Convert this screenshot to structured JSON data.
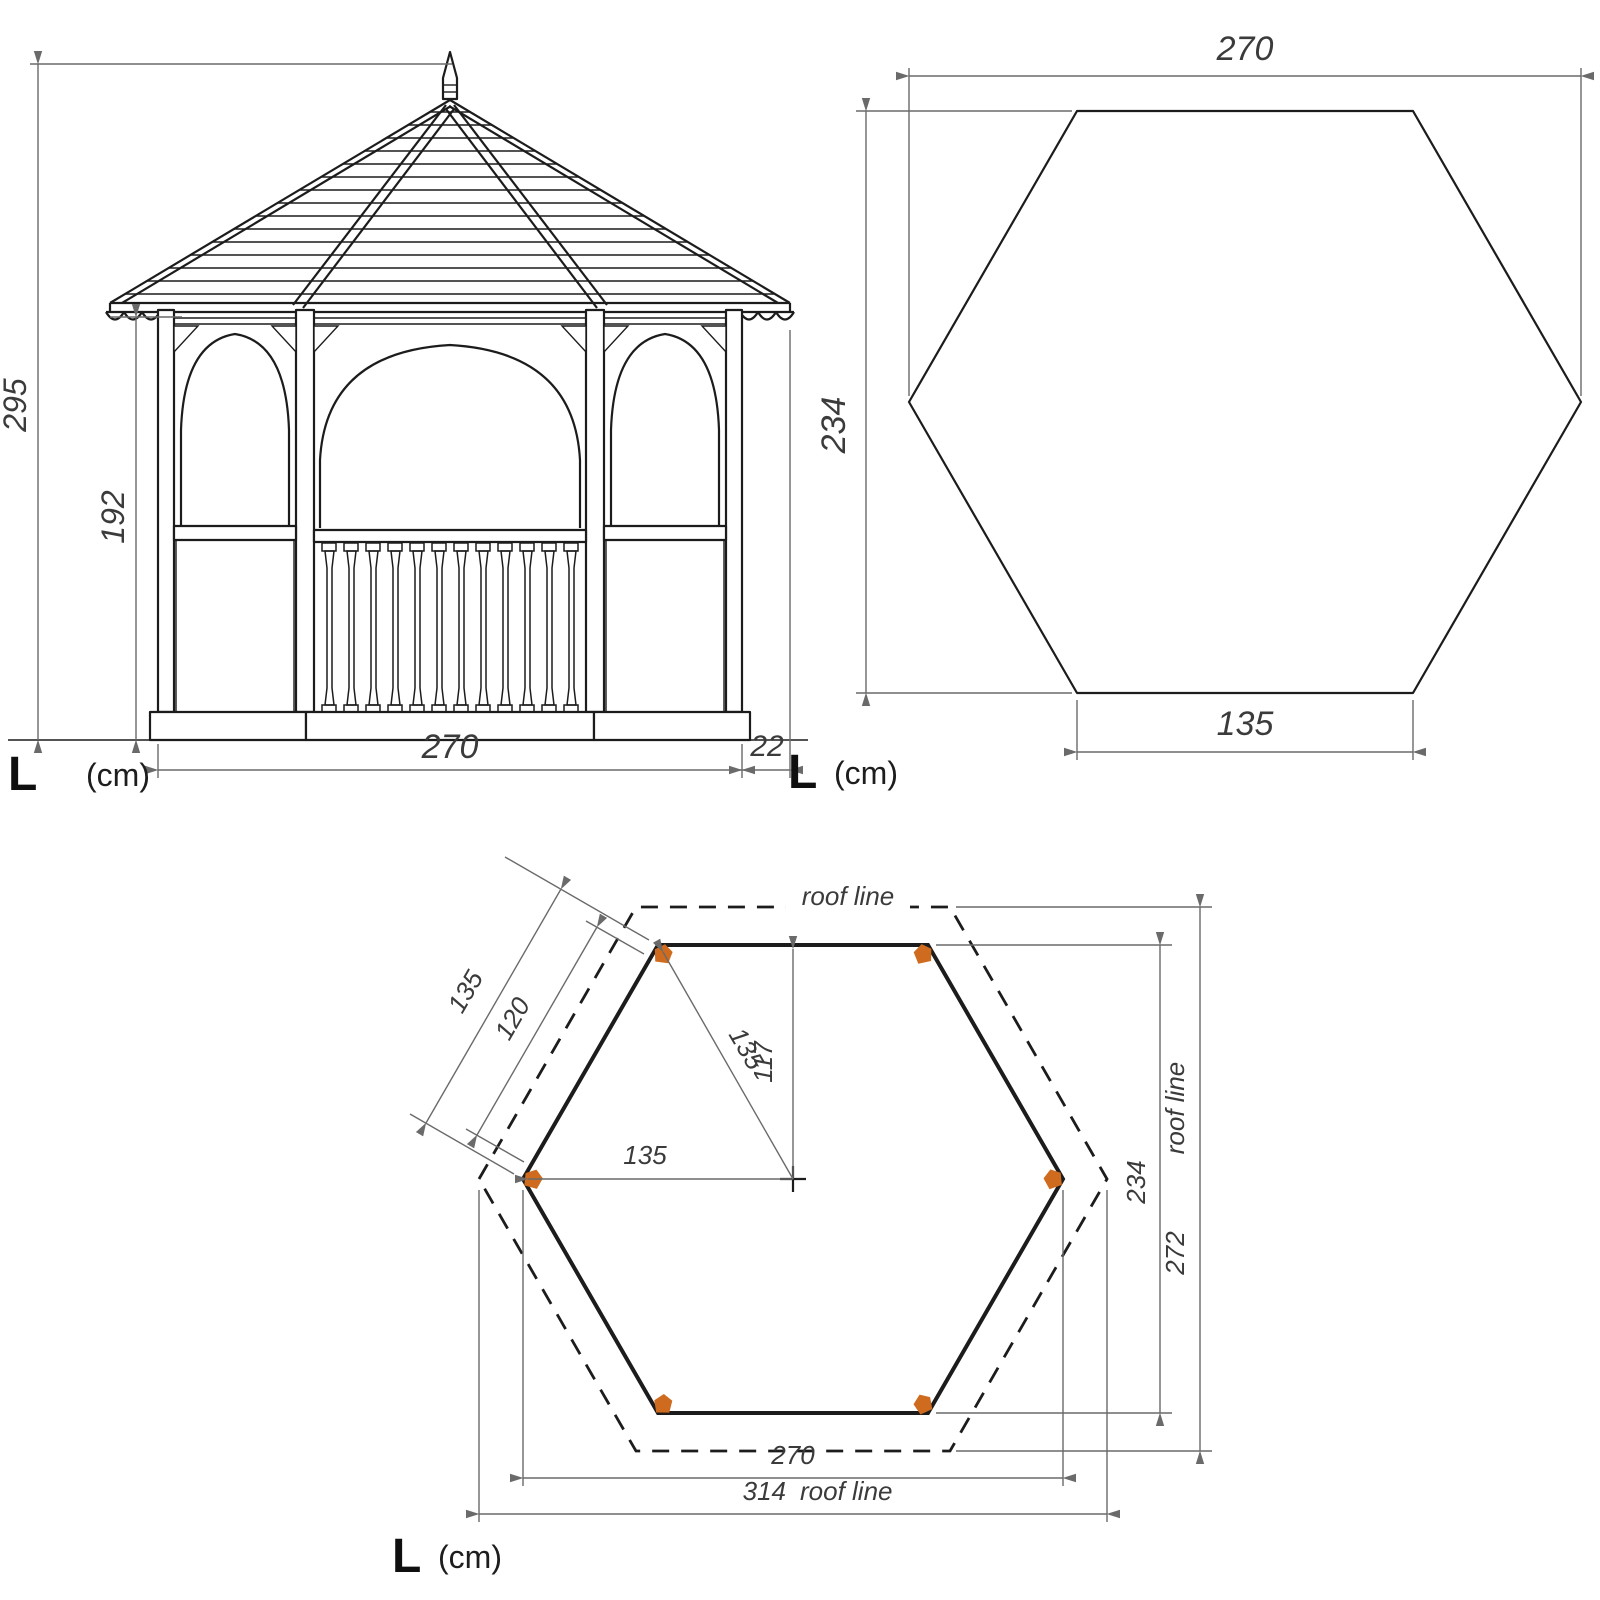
{
  "document_type": "gazebo dimension drawing",
  "colors": {
    "background": "#ffffff",
    "line": "#1c1c1c",
    "dimension": "#6a6a6a",
    "text": "#3b3b3b",
    "post_marker": "#cf6b1e"
  },
  "front_elevation": {
    "total_height": "295",
    "post_height": "192",
    "width": "270",
    "overhang": "22",
    "unit_label": "L",
    "unit_suffix": "(cm)"
  },
  "roof_plan": {
    "width": "270",
    "depth": "234",
    "front_side": "135",
    "unit_label": "L",
    "unit_suffix": "(cm)"
  },
  "floor_plan": {
    "roof_line_label": "roof line",
    "side_length": "135",
    "post_spacing": "120",
    "radius": "135",
    "apothem": "117",
    "half_width": "135",
    "depth": "234",
    "roof_depth": "272",
    "roof_depth_suffix": "roof line",
    "width": "270",
    "roof_width": "314",
    "roof_width_suffix": "roof line",
    "unit_label": "L",
    "unit_suffix": "(cm)"
  }
}
